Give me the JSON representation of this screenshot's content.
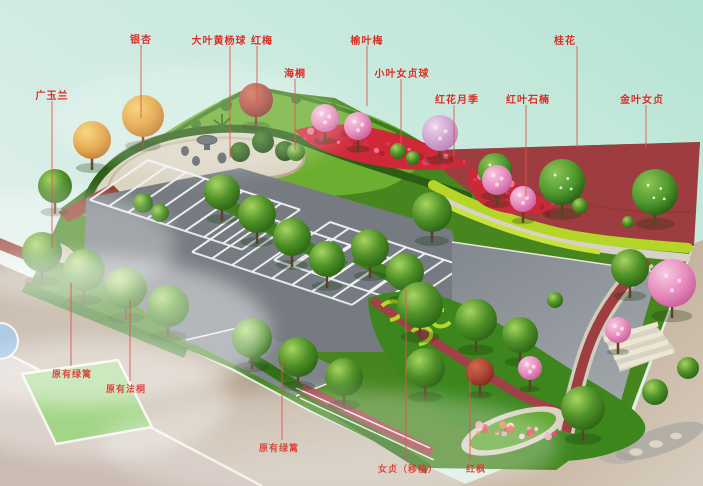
{
  "annotation": {
    "color": "#d92f27",
    "line_color": "#e2564e"
  },
  "palette": {
    "sky_top_right": "#b7e5d6",
    "sky_bottom_left": "#eef4ef",
    "asphalt": "#757b81",
    "plaza_gray": "#8f959b",
    "grass_base": "#47851f",
    "berm_green": "#6cae2f",
    "hedge_dark": "#2a5e12",
    "red_pavement": "#9e3d3f",
    "red_flowers": "#cf2838",
    "yellow_hedge": "#b5d626",
    "road_tan": "#9f8a6f",
    "gravel": "#d3cdbd",
    "lawn": "#72bf4a"
  },
  "plant_labels": [
    {
      "id": "guang-yu-lan",
      "text": "广玉兰",
      "x": 52,
      "y": 88,
      "line_x": 52,
      "line_y1": 101,
      "line_y2": 248
    },
    {
      "id": "yin-xing",
      "text": "银杏",
      "x": 141,
      "y": 32,
      "line_x": 141,
      "line_y1": 45,
      "line_y2": 118
    },
    {
      "id": "da-ye-huang-yang-qiu",
      "text": "大叶黄杨球",
      "x": 219,
      "y": 33,
      "line_x": 230,
      "line_y1": 46,
      "line_y2": 158
    },
    {
      "id": "hong-mei",
      "text": "红梅",
      "x": 262,
      "y": 33,
      "line_x": 257,
      "line_y1": 46,
      "line_y2": 103
    },
    {
      "id": "hai-tong",
      "text": "海桐",
      "x": 295,
      "y": 66,
      "line_x": 295,
      "line_y1": 79,
      "line_y2": 150
    },
    {
      "id": "yu-ye-mei",
      "text": "榆叶梅",
      "x": 367,
      "y": 33,
      "line_x": 367,
      "line_y1": 46,
      "line_y2": 106
    },
    {
      "id": "xiao-ye-nv-zhen-qiu",
      "text": "小叶女贞球",
      "x": 402,
      "y": 66,
      "line_x": 401,
      "line_y1": 79,
      "line_y2": 148
    },
    {
      "id": "hong-hua-yue-ji",
      "text": "红花月季",
      "x": 457,
      "y": 92,
      "line_x": 454,
      "line_y1": 105,
      "line_y2": 162
    },
    {
      "id": "hong-ye-shi-nan",
      "text": "红叶石楠",
      "x": 528,
      "y": 92,
      "line_x": 526,
      "line_y1": 105,
      "line_y2": 197
    },
    {
      "id": "gui-hua",
      "text": "桂花",
      "x": 565,
      "y": 33,
      "line_x": 577,
      "line_y1": 46,
      "line_y2": 147
    },
    {
      "id": "jin-ye-nv-zhen",
      "text": "金叶女贞",
      "x": 642,
      "y": 92,
      "line_x": 646,
      "line_y1": 105,
      "line_y2": 147
    },
    {
      "id": "yuan-you-lv-li-1",
      "text": "原有绿篱",
      "x": 72,
      "y": 368,
      "line_x": 71,
      "line_y1": 283,
      "line_y2": 366
    },
    {
      "id": "yuan-you-fa-tong",
      "text": "原有法桐",
      "x": 126,
      "y": 383,
      "line_x": 130,
      "line_y1": 300,
      "line_y2": 381
    },
    {
      "id": "yuan-you-lv-li-2",
      "text": "原有绿篱",
      "x": 279,
      "y": 442,
      "line_x": 282,
      "line_y1": 357,
      "line_y2": 440
    },
    {
      "id": "nv-zhen-yi-zhi",
      "text": "女贞（移植）",
      "x": 408,
      "y": 463,
      "line_x": 406,
      "line_y1": 290,
      "line_y2": 461
    },
    {
      "id": "hong-feng",
      "text": "红枫",
      "x": 476,
      "y": 463,
      "line_x": 470,
      "line_y1": 372,
      "line_y2": 461
    }
  ]
}
